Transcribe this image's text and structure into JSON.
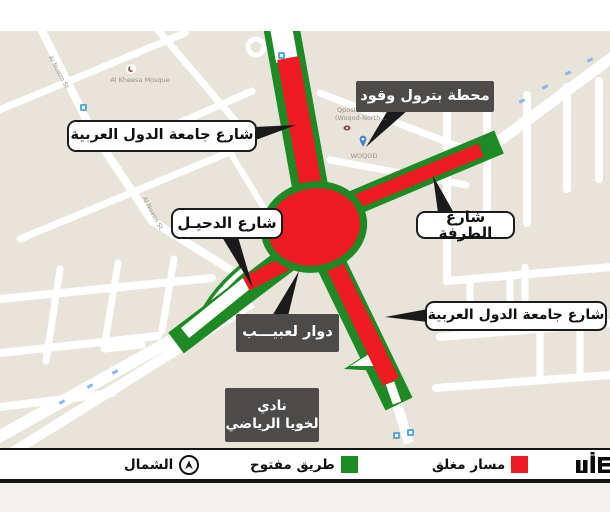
{
  "map": {
    "pois": {
      "mosque": "Al Kheesa Mosque",
      "street_nw": "Al Nuaim St",
      "street_mid": "Al Nuaim St",
      "qpost_line1": "Qpost Branch",
      "qpost_line2": "(Woqod-North...",
      "woqod": "WOQOD"
    },
    "callouts": {
      "arab_league_street_nw": "شارع جامعة الدول العربية",
      "al_duhail_street": "شارع الدحيـل",
      "al_tarfa_street": "شارع الطرفة",
      "arab_league_street_se": "شارع جامعة الدول العربية",
      "petrol_station": "محطة بترول وقود",
      "lebaib_roundabout": "دوار لعبيـــب",
      "club_line1": "نادي",
      "club_line2": "لخويا الرياضي"
    }
  },
  "legend": {
    "north_label": "الشمال",
    "open_road_label": "طريق مفتوح",
    "closed_lane_label": "مسار مغلق",
    "open_road_color": "#1d8a26",
    "closed_lane_color": "#ee1b23",
    "logo_name": "ashghal-logo"
  },
  "colors": {
    "map_background": "#e9e4da",
    "road_open_green": "#1d8a26",
    "road_closed_red": "#ee1b23",
    "callout_dark_bg": "#4d4b49",
    "callout_white_border": "#1b1b1b"
  }
}
